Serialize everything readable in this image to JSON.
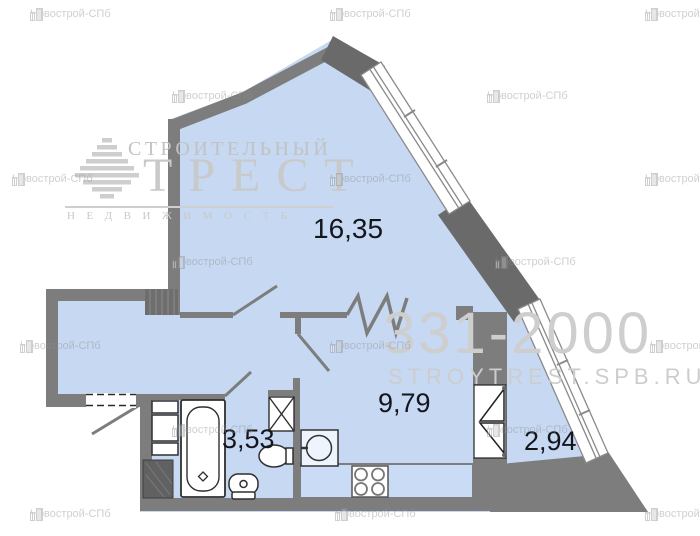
{
  "plan": {
    "rooms": [
      {
        "name": "living-room",
        "area_label": "16,35"
      },
      {
        "name": "kitchen-living",
        "area_label": "9,79"
      },
      {
        "name": "bathroom",
        "area_label": "3,53"
      },
      {
        "name": "balcony",
        "area_label": "2,94"
      }
    ]
  },
  "watermarks": {
    "agency_label": "Новострой-СПб",
    "agency_icon": "building-icon",
    "brand_line1": "СТРОИТЕЛЬНЫЙ",
    "brand_line2": "ТРЕСТ",
    "brand_line3": "НЕДВИЖИМОСТЬ",
    "brand_icon": "pyramid-logo-icon",
    "phone": "331-2000",
    "website": "STROYTREST.SPB.RU",
    "positions": [
      [
        30,
        8
      ],
      [
        330,
        8
      ],
      [
        645,
        8
      ],
      [
        172,
        90
      ],
      [
        487,
        90
      ],
      [
        12,
        173
      ],
      [
        330,
        173
      ],
      [
        645,
        173
      ],
      [
        172,
        256
      ],
      [
        495,
        256
      ],
      [
        20,
        340
      ],
      [
        330,
        340
      ],
      [
        650,
        340
      ],
      [
        172,
        424
      ],
      [
        487,
        424
      ],
      [
        30,
        508
      ],
      [
        335,
        508
      ],
      [
        645,
        508
      ]
    ]
  },
  "colors": {
    "floor_fill": "#c6d8f2",
    "counter_fill": "#cadcf5",
    "wall": "#7d7d7d",
    "wall_dark": "#6a6a6a",
    "label_text": "#15151c",
    "watermark_gray": "#c9c9c9"
  }
}
